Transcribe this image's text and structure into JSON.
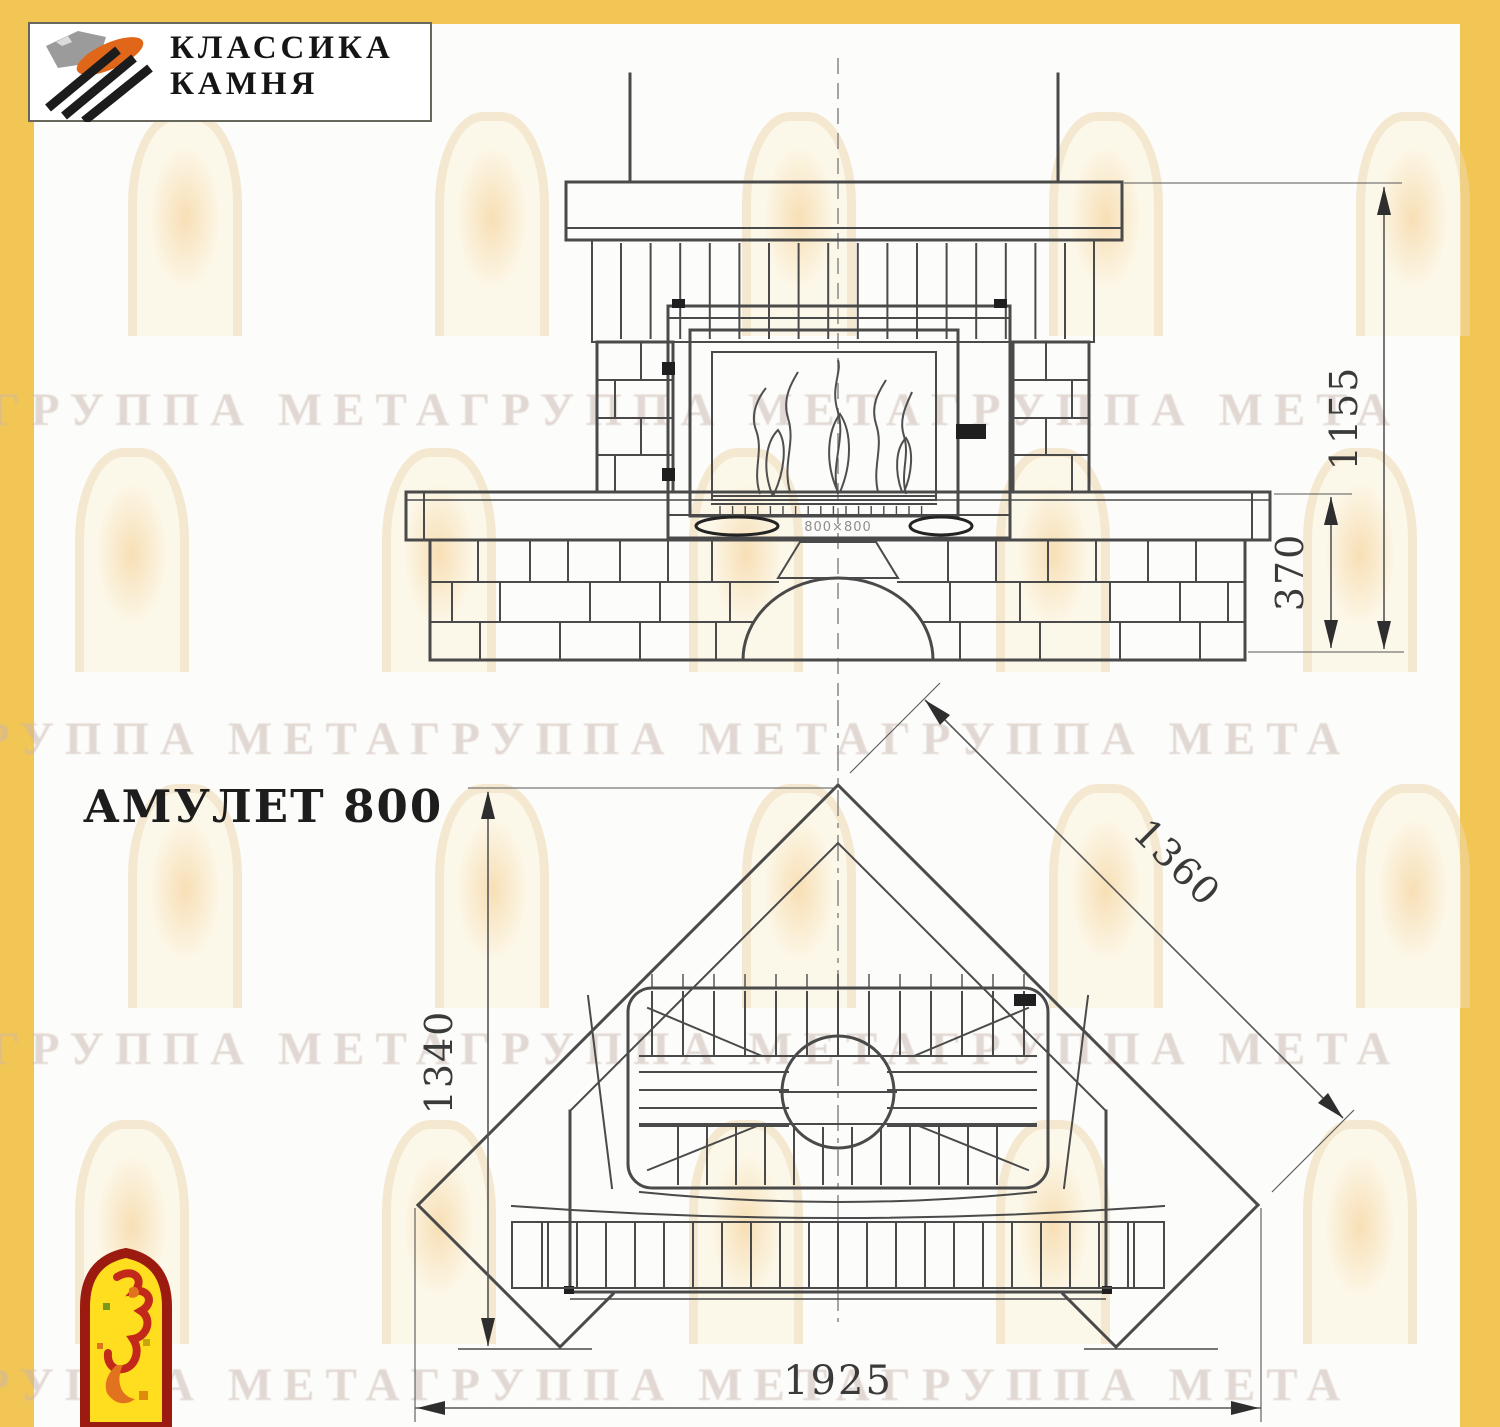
{
  "header": {
    "brand_line1": "КЛАССИКА",
    "brand_line2": "КАМНЯ"
  },
  "product": {
    "title": "АМУЛЕТ 800"
  },
  "watermark": {
    "text": "ГРУППА МЕТАГРУППА МЕТАГРУППА МЕТА"
  },
  "drawing": {
    "front_view": {
      "dim_total_height": "1155",
      "dim_bench_height": "370",
      "insert_marking": "800×800"
    },
    "plan_view": {
      "dim_depth": "1340",
      "dim_diagonal": "1360",
      "dim_width": "1925"
    }
  },
  "colors": {
    "accent_yellow": "#F2C654",
    "drawing_line": "#4a4a4a",
    "dim_line": "#565656",
    "watermark_text": "#c9b6ae",
    "watermark_arch_border": "#f0d9ae",
    "watermark_arch_fill": "#fdf5dc",
    "watermark_arch_glow": "#f5c87e",
    "logo_stone_gray": "#9b9b9b",
    "logo_stone_orange": "#E0661A",
    "logo_black": "#1c1c1c",
    "corner_logo_border": "#9B1B10",
    "corner_logo_fill": "#FFDE1F",
    "corner_logo_red": "#C3291B",
    "corner_logo_orange": "#E1731F"
  }
}
